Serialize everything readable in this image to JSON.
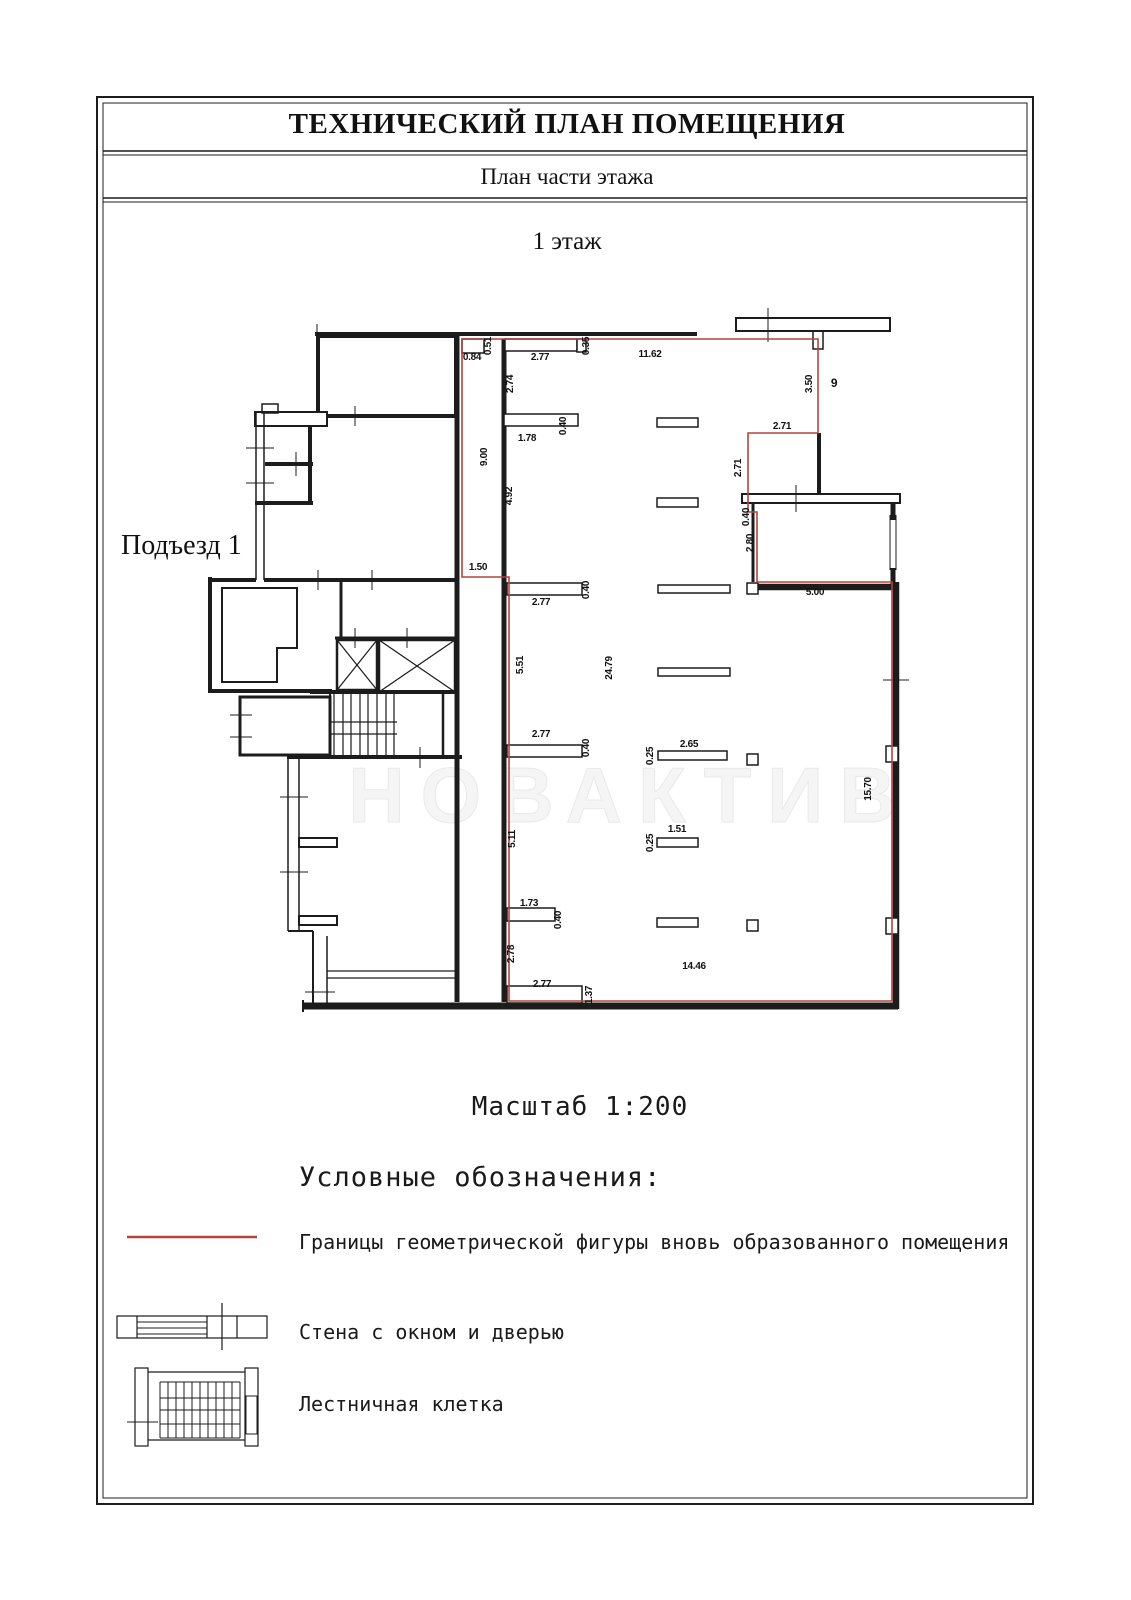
{
  "page": {
    "title": "ТЕХНИЧЕСКИЙ ПЛАН ПОМЕЩЕНИЯ",
    "subtitle": "План части этажа",
    "floor_label": "1 этаж",
    "scale_label": "Масштаб 1:200"
  },
  "plan": {
    "entrance_label": "Подъезд 1",
    "room_number": "9",
    "watermark": "НОВАКТИВ"
  },
  "colors": {
    "boundary_red": "#b5433b",
    "wall": "#1c1c1c",
    "watermark_gray": "#f2f2f2"
  },
  "legend": {
    "title": "Условные обозначения:",
    "items": [
      {
        "symbol": "red-boundary-line",
        "label": "Границы геометрической фигуры вновь образованного помещения"
      },
      {
        "symbol": "wall-window-door",
        "label": "Стена с окном и дверью"
      },
      {
        "symbol": "staircase",
        "label": "Лестничная клетка"
      }
    ]
  },
  "dimensions": [
    {
      "text": "0.84",
      "x": 472,
      "y": 360,
      "rot": 0
    },
    {
      "text": "0.51",
      "x": 491,
      "y": 346,
      "rot": 1
    },
    {
      "text": "2.77",
      "x": 540,
      "y": 360,
      "rot": 0
    },
    {
      "text": "0.35",
      "x": 589,
      "y": 346,
      "rot": 1
    },
    {
      "text": "11.62",
      "x": 650,
      "y": 357,
      "rot": 0
    },
    {
      "text": "2.74",
      "x": 513,
      "y": 384,
      "rot": 1
    },
    {
      "text": "0.40",
      "x": 566,
      "y": 426,
      "rot": 1
    },
    {
      "text": "1.78",
      "x": 527,
      "y": 441,
      "rot": 0
    },
    {
      "text": "9.00",
      "x": 487,
      "y": 457,
      "rot": 1
    },
    {
      "text": "4.92",
      "x": 512,
      "y": 496,
      "rot": 1
    },
    {
      "text": "3.50",
      "x": 812,
      "y": 384,
      "rot": 1
    },
    {
      "text": "9",
      "x": 834,
      "y": 387,
      "rot": 0,
      "red": true
    },
    {
      "text": "2.71",
      "x": 782,
      "y": 429,
      "rot": 0
    },
    {
      "text": "2.71",
      "x": 741,
      "y": 468,
      "rot": 1
    },
    {
      "text": "0.40",
      "x": 749,
      "y": 517,
      "rot": 1
    },
    {
      "text": "2.80",
      "x": 753,
      "y": 543,
      "rot": 1
    },
    {
      "text": "5.00",
      "x": 815,
      "y": 595,
      "rot": 0
    },
    {
      "text": "1.50",
      "x": 478,
      "y": 570,
      "rot": 0
    },
    {
      "text": "0.40",
      "x": 589,
      "y": 590,
      "rot": 1
    },
    {
      "text": "2.77",
      "x": 541,
      "y": 605,
      "rot": 0
    },
    {
      "text": "5.51",
      "x": 523,
      "y": 665,
      "rot": 1
    },
    {
      "text": "24.79",
      "x": 612,
      "y": 668,
      "rot": 1
    },
    {
      "text": "2.77",
      "x": 541,
      "y": 737,
      "rot": 0
    },
    {
      "text": "0.40",
      "x": 589,
      "y": 748,
      "rot": 1
    },
    {
      "text": "0.25",
      "x": 653,
      "y": 756,
      "rot": 1
    },
    {
      "text": "2.65",
      "x": 689,
      "y": 747,
      "rot": 0
    },
    {
      "text": "15.70",
      "x": 871,
      "y": 789,
      "rot": 1
    },
    {
      "text": "5.11",
      "x": 515,
      "y": 839,
      "rot": 1
    },
    {
      "text": "1.51",
      "x": 677,
      "y": 832,
      "rot": 0
    },
    {
      "text": "0.25",
      "x": 653,
      "y": 843,
      "rot": 1
    },
    {
      "text": "1.73",
      "x": 529,
      "y": 906,
      "rot": 0
    },
    {
      "text": "0.40",
      "x": 561,
      "y": 920,
      "rot": 1
    },
    {
      "text": "2.78",
      "x": 514,
      "y": 954,
      "rot": 1
    },
    {
      "text": "14.46",
      "x": 694,
      "y": 969,
      "rot": 0
    },
    {
      "text": "2.77",
      "x": 542,
      "y": 987,
      "rot": 0
    },
    {
      "text": "1.37",
      "x": 592,
      "y": 995,
      "rot": 1
    }
  ]
}
